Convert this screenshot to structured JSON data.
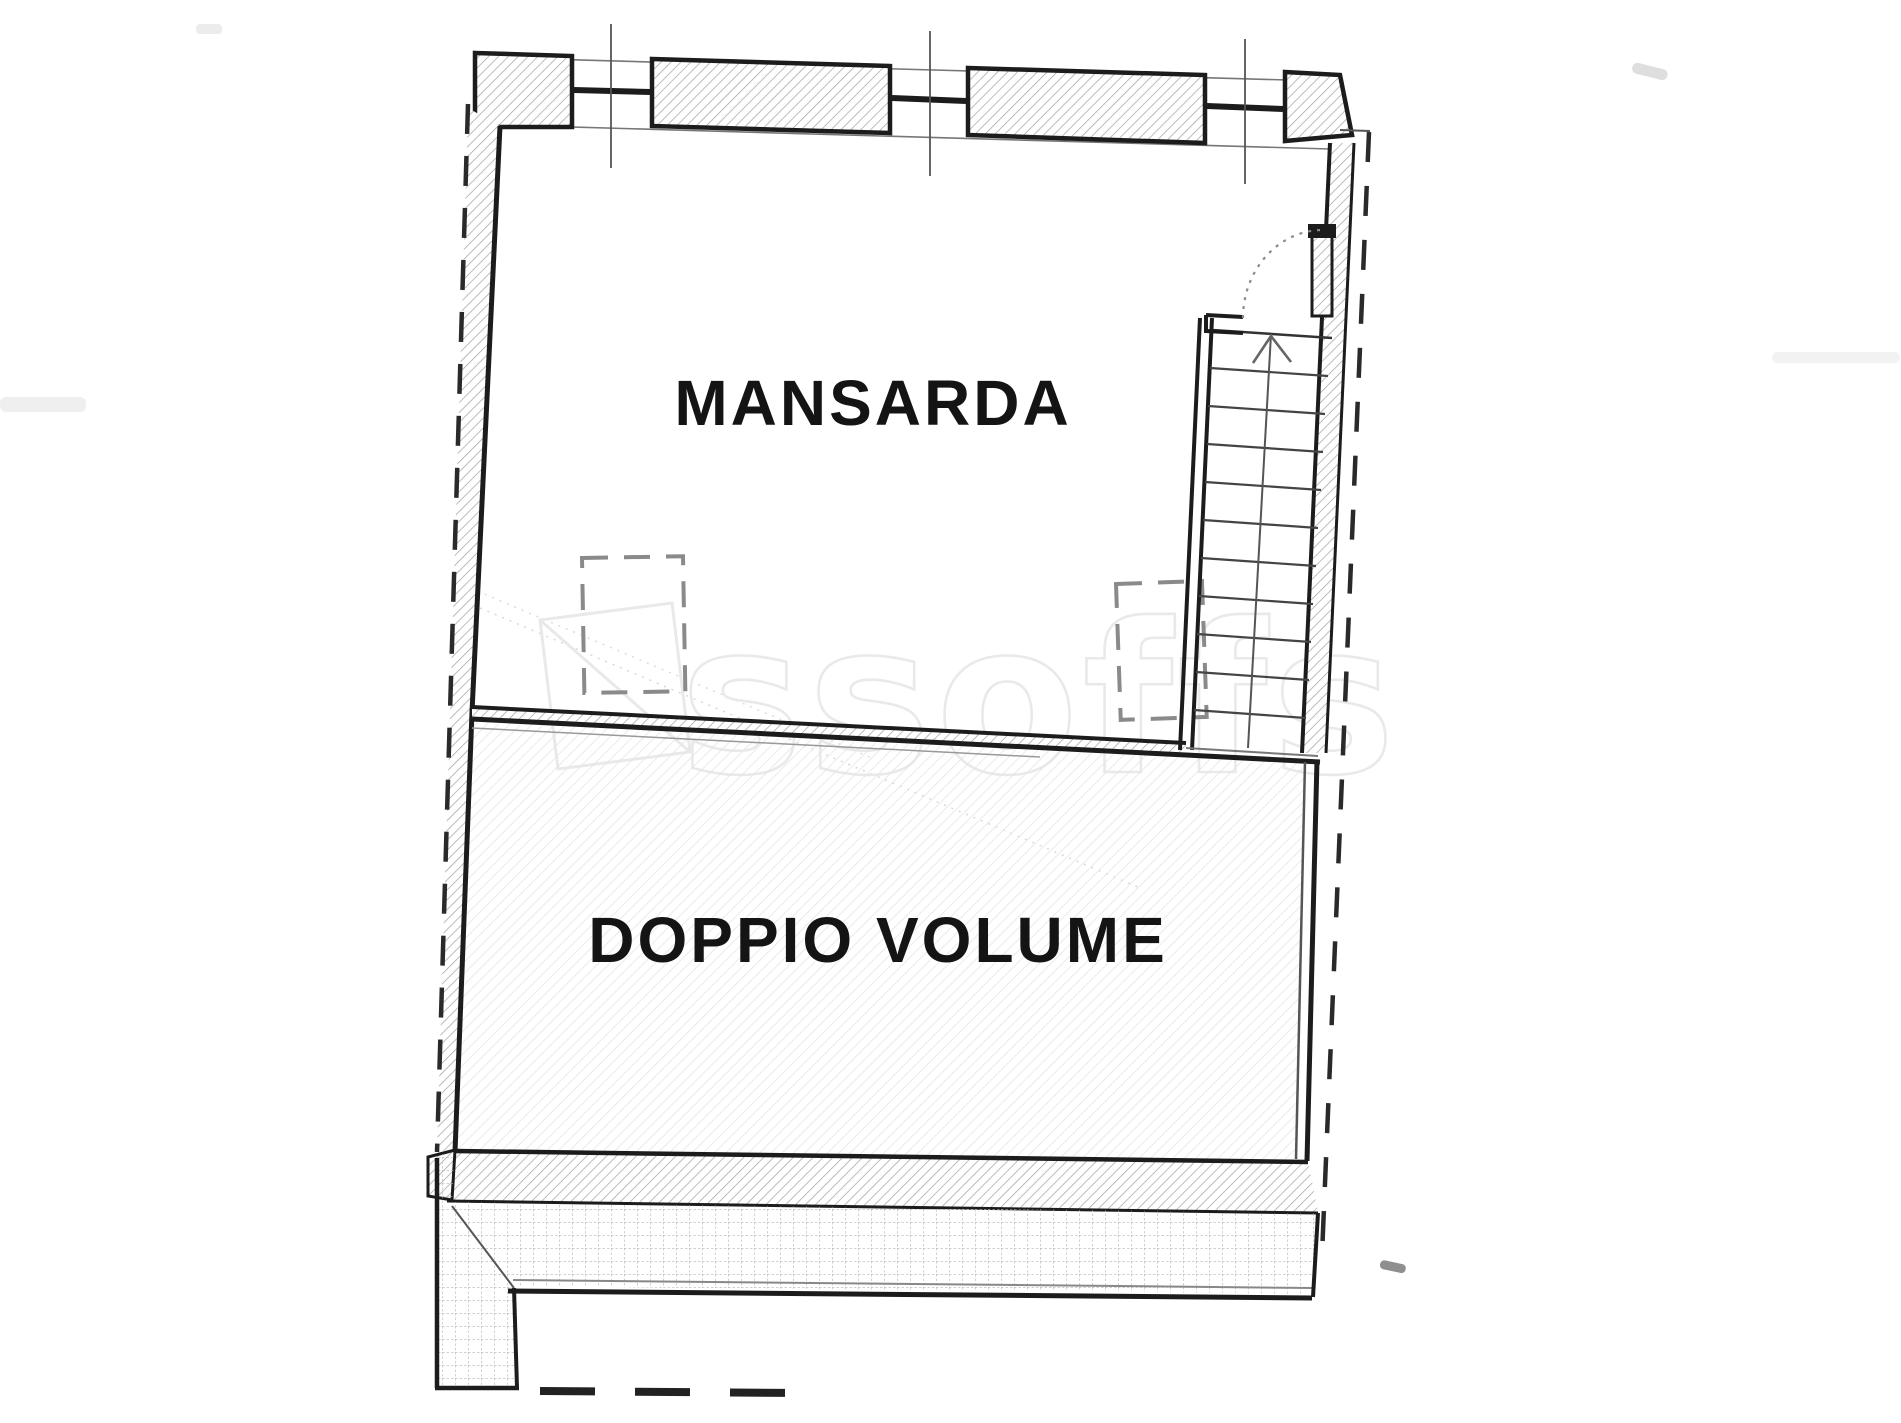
{
  "page": {
    "type": "scanned-floor-plan",
    "background": "#ffffff"
  },
  "labels": {
    "room_upper": "MANSARDA",
    "room_lower": "DOPPIO VOLUME"
  },
  "watermark": {
    "text": "ssoffs"
  },
  "stair": {
    "tread_lines": 10,
    "direction": "up"
  },
  "features": {
    "windows_in_top_wall": 3,
    "door_swing_arc": "dotted",
    "dashed_skylight_rectangles": 2,
    "terrace_strip": "gridded",
    "boundary_line": "dashed"
  },
  "colors": {
    "ink": "#1c1c1c",
    "wall_hatch": "#9f9f9f",
    "room_hatch": "#e6e6e6",
    "terrace_grid": "#b3b3b3",
    "dashed_boundary": "#2a2a2a",
    "watermark": "#e9e9e9"
  }
}
